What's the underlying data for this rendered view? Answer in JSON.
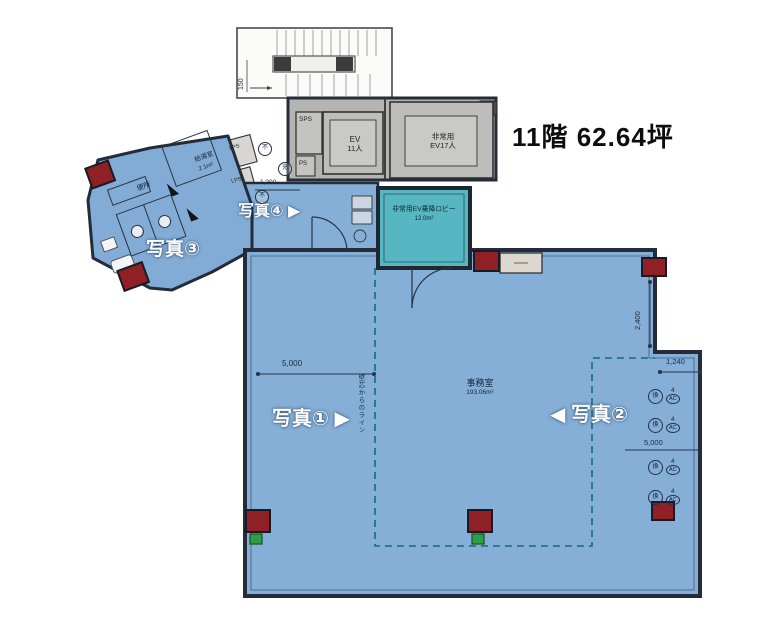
{
  "title": "11階 62.64坪",
  "photos": {
    "p1": "写真①",
    "p1_arrow": "▶",
    "p2": "写真②",
    "p2_arrow": "◀",
    "p3": "写真③",
    "p4": "写真④",
    "p4_arrow": "▶"
  },
  "rooms": {
    "office_name": "事務室",
    "office_area": "193.06m²",
    "lobby_name": "非常用EV乗降ロビー",
    "lobby_area": "12.0m²",
    "ev_main_l1": "EV",
    "ev_main_l2": "11人",
    "ev_emg_l1": "非常用",
    "ev_emg_l2": "EV17人",
    "sps": "SPS",
    "ps": "PS",
    "lps_a": "LPS",
    "lps_b": "LPS",
    "kyuto_name": "給湯室",
    "kyuto_area": "2.1m²",
    "toilet": "便所"
  },
  "dimensions": {
    "stair_150": "150",
    "corridor_1200": "1,200",
    "office_5000_left": "5,000",
    "office_5000_right": "5,000",
    "notch_2400": "2,400",
    "notch_1240": "1,240"
  },
  "annotations": {
    "net_line": "壁芯からのライン",
    "mark_a": "不",
    "mark_b": "充",
    "mark_c": "不",
    "ac_glyph": "換",
    "ac_count": "4",
    "ac_label": "AC"
  },
  "colors": {
    "room_blue": "#85afd7",
    "lobby_teal": "#56b6c1",
    "service_gray": "#b4b4b2",
    "wall": "#242c3a",
    "column_red": "#8e2026",
    "marker_green": "#2f9e44",
    "net_dash": "#156b75"
  }
}
